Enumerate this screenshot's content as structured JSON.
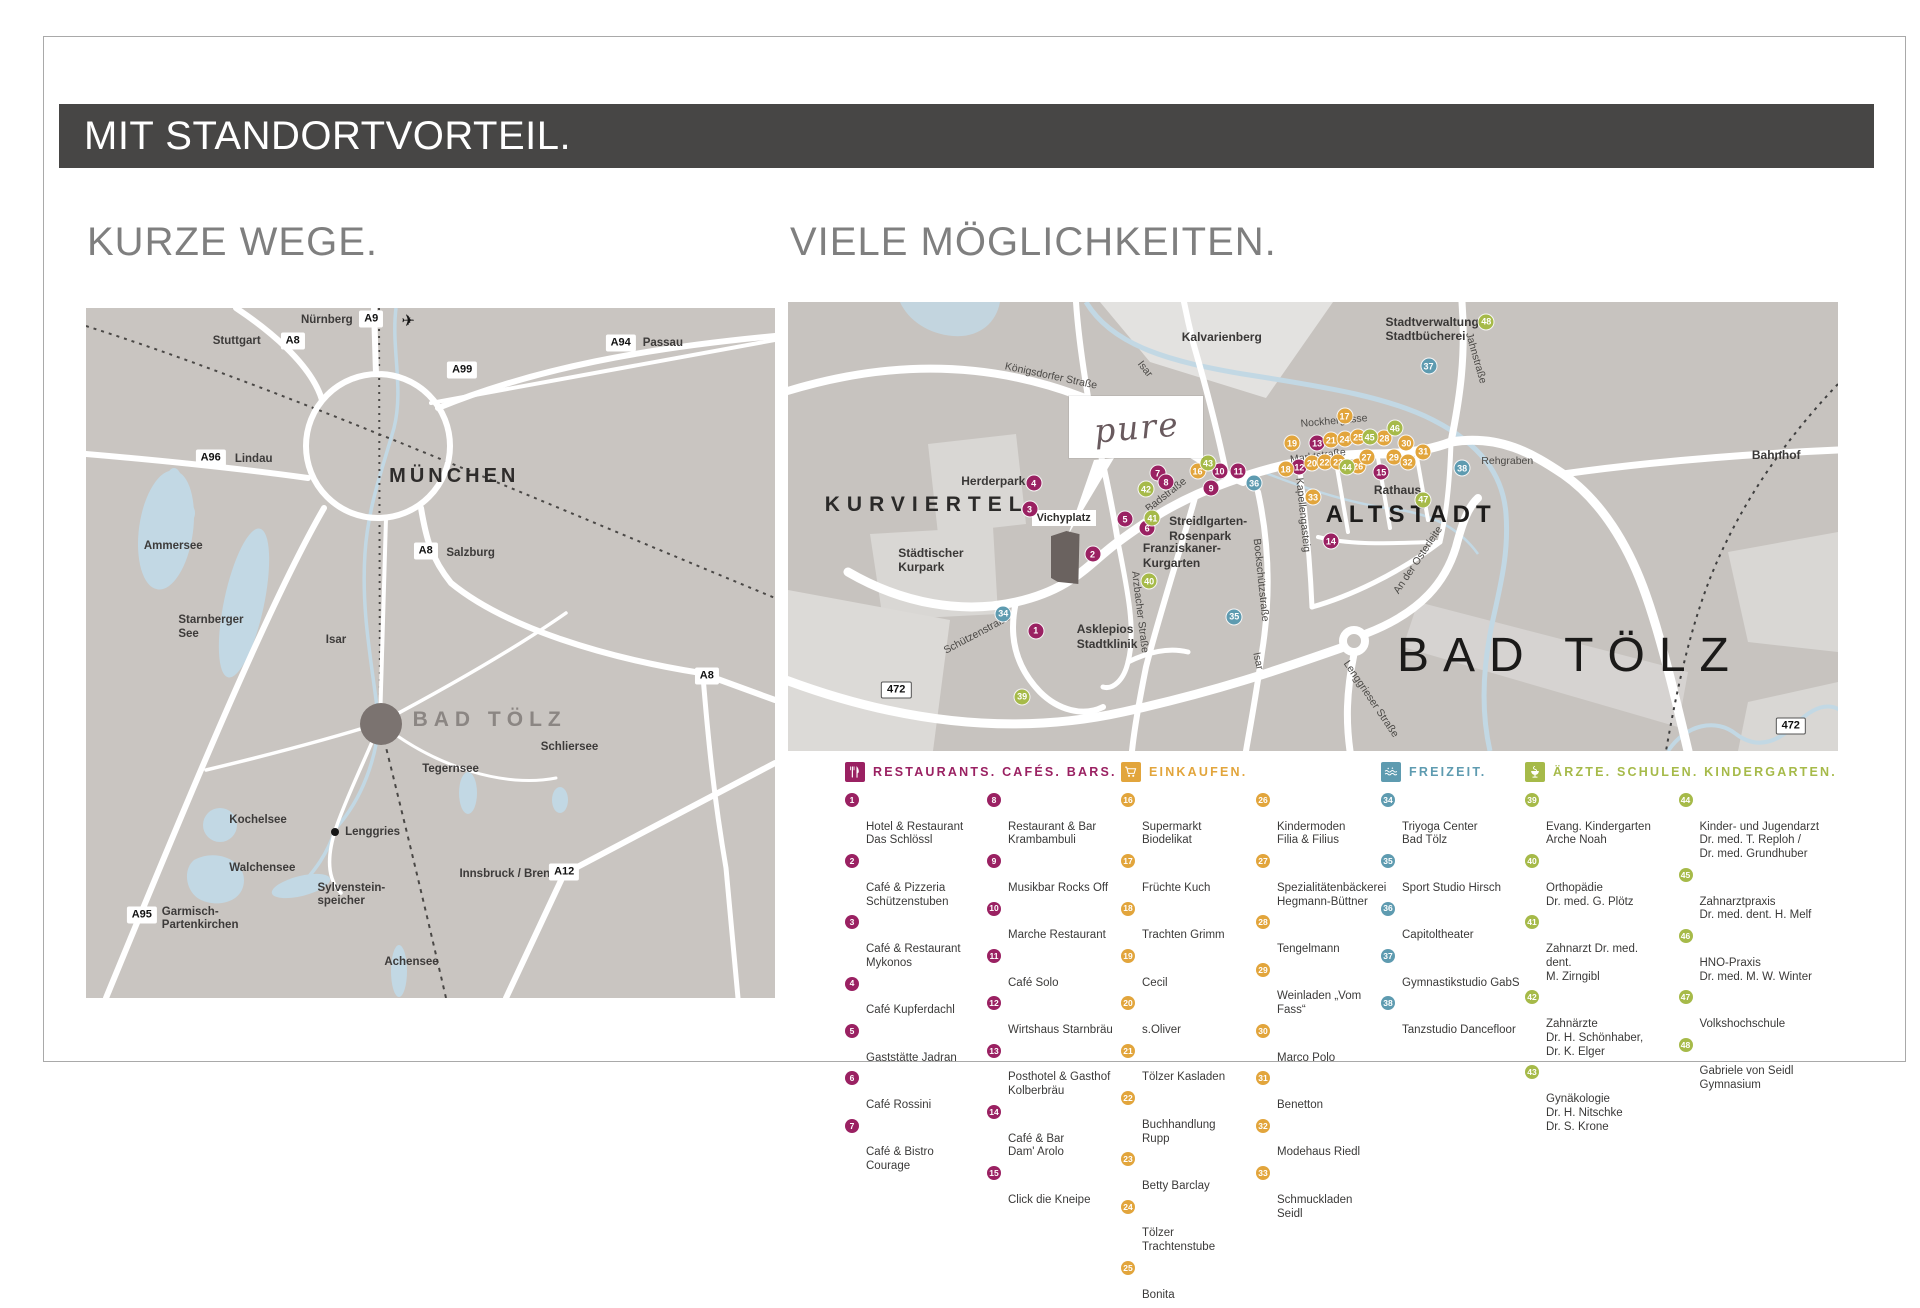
{
  "slide": {
    "title": "MIT STANDORTVORTEIL."
  },
  "headings": {
    "left": "KURZE WEGE.",
    "right": "VIELE MÖGLICHKEITEN."
  },
  "colors": {
    "bar_bg": "#474645",
    "heading": "#7f7f7f",
    "map_bg": "#c9c5c1",
    "map_bg2": "#c7c3bf",
    "water": "#c2d8e4",
    "rest": "#9a2162",
    "shop": "#e2a53c",
    "leisure": "#5e9bb0",
    "health": "#a6ba49",
    "bad_toelz_dot": "#7b7370",
    "bad_toelz_text": "#8b8683",
    "building": "#6a625f",
    "item_text": "#3b3a39",
    "map_label": "#3d3b3a"
  },
  "overview_map": {
    "munich": "MÜNCHEN",
    "bad_toelz": "BAD TÖLZ",
    "plane_icon": "✈",
    "motorway_badges": [
      {
        "t": "A9",
        "x": "41.4%",
        "y": "1.6%"
      },
      {
        "t": "A8",
        "x": "30.0%",
        "y": "4.8%"
      },
      {
        "t": "A94",
        "x": "77.6%",
        "y": "5.0%"
      },
      {
        "t": "A99",
        "x": "54.6%",
        "y": "9.0%"
      },
      {
        "t": "A96",
        "x": "18.1%",
        "y": "21.7%"
      },
      {
        "t": "A8",
        "x": "49.3%",
        "y": "35.2%"
      },
      {
        "t": "A8",
        "x": "90.1%",
        "y": "53.3%"
      },
      {
        "t": "A95",
        "x": "8.1%",
        "y": "88.0%"
      },
      {
        "t": "A12",
        "x": "69.4%",
        "y": "81.8%"
      }
    ],
    "place_labels": [
      {
        "t": "Nürnberg",
        "x": "31.2%",
        "y": "0.9%"
      },
      {
        "t": "Stuttgart",
        "x": "18.4%",
        "y": "3.9%"
      },
      {
        "t": "Passau",
        "x": "80.8%",
        "y": "4.2%"
      },
      {
        "t": "Lindau",
        "x": "21.6%",
        "y": "21.0%"
      },
      {
        "t": "Salzburg",
        "x": "52.3%",
        "y": "34.6%"
      },
      {
        "t": "Ammersee",
        "x": "8.4%",
        "y": "33.6%"
      },
      {
        "t": "Starnberger\nSee",
        "x": "13.4%",
        "y": "44.4%"
      },
      {
        "t": "Isar",
        "x": "34.8%",
        "y": "47.2%"
      },
      {
        "t": "Schliersee",
        "x": "66.0%",
        "y": "62.8%"
      },
      {
        "t": "Tegernsee",
        "x": "48.8%",
        "y": "65.9%"
      },
      {
        "t": "Kochelsee",
        "x": "20.8%",
        "y": "73.4%"
      },
      {
        "t": "Lenggries",
        "x": "37.6%",
        "y": "75.0%"
      },
      {
        "t": "Walchensee",
        "x": "20.8%",
        "y": "80.3%"
      },
      {
        "t": "Sylvenstein-\nspeicher",
        "x": "33.6%",
        "y": "83.2%"
      },
      {
        "t": "Garmisch-\nPartenkirchen",
        "x": "11.0%",
        "y": "86.6%"
      },
      {
        "t": "Innsbruck / Brenner",
        "x": "54.2%",
        "y": "81.2%"
      },
      {
        "t": "Achensee",
        "x": "43.3%",
        "y": "93.9%"
      }
    ]
  },
  "city_map": {
    "pure_logo": "pure",
    "big_label": "BAD TÖLZ",
    "kurviertel": "KURVIERTEL",
    "altstadt": "ALTSTADT",
    "vichyplatz": "Vichyplatz",
    "area_labels": [
      {
        "t": "Kalvarienberg",
        "x": "37.5%",
        "y": "6.3%"
      },
      {
        "t": "Stadtverwaltung\nStadtbücherei",
        "x": "56.9%",
        "y": "2.8%"
      },
      {
        "t": "Herderpark",
        "x": "16.5%",
        "y": "38.3%"
      },
      {
        "t": "Städtischer\nKurpark",
        "x": "10.5%",
        "y": "54.3%"
      },
      {
        "t": "Asklepios\nStadtklinik",
        "x": "27.5%",
        "y": "71.3%"
      },
      {
        "t": "Streidlgarten-\nRosenpark",
        "x": "36.3%",
        "y": "47.3%"
      },
      {
        "t": "Franziskaner-\nKurgarten",
        "x": "33.8%",
        "y": "53.3%"
      },
      {
        "t": "Rathaus",
        "x": "55.8%",
        "y": "40.3%"
      },
      {
        "t": "Bahnhof",
        "x": "91.8%",
        "y": "32.6%"
      }
    ],
    "street_labels": [
      {
        "t": "Königsdorfer Straße",
        "x": "25%",
        "y": "16.5%",
        "rot": "12deg"
      },
      {
        "t": "Isar",
        "x": "34%",
        "y": "15%",
        "rot": "52deg"
      },
      {
        "t": "Nockhergasse",
        "x": "52%",
        "y": "26.5%",
        "rot": "-5deg"
      },
      {
        "t": "Marktstraße",
        "x": "50.5%",
        "y": "34.3%",
        "rot": "-8deg"
      },
      {
        "t": "Jahnstraße",
        "x": "65.5%",
        "y": "12.5%",
        "rot": "74deg"
      },
      {
        "t": "Badstraße",
        "x": "36%",
        "y": "43%",
        "rot": "-38deg"
      },
      {
        "t": "Schützenstraße",
        "x": "18%",
        "y": "74%",
        "rot": "-28deg"
      },
      {
        "t": "Arzbacher Straße",
        "x": "33.5%",
        "y": "69%",
        "rot": "83deg"
      },
      {
        "t": "Bockschützstraße",
        "x": "45%",
        "y": "62%",
        "rot": "84deg"
      },
      {
        "t": "Kapellengasteig",
        "x": "49%",
        "y": "47.5%",
        "rot": "84deg"
      },
      {
        "t": "An der Osterleite",
        "x": "60%",
        "y": "57.5%",
        "rot": "-56deg"
      },
      {
        "t": "Isar",
        "x": "44.8%",
        "y": "80%",
        "rot": "78deg"
      },
      {
        "t": "Lenggrieser Straße",
        "x": "55.5%",
        "y": "88.5%",
        "rot": "56deg"
      },
      {
        "t": "Rehgraben",
        "x": "68.5%",
        "y": "35.5%",
        "rot": "0deg"
      }
    ],
    "route_badges": [
      {
        "t": "472",
        "x": "10.3%",
        "y": "86.5%"
      },
      {
        "t": "472",
        "x": "95.5%",
        "y": "94.5%"
      }
    ],
    "pois": {
      "restaurants": [
        {
          "n": "1",
          "x": "23.6%",
          "y": "73.2%"
        },
        {
          "n": "2",
          "x": "29.0%",
          "y": "56.2%"
        },
        {
          "n": "3",
          "x": "23.0%",
          "y": "46.2%"
        },
        {
          "n": "4",
          "x": "23.4%",
          "y": "40.4%"
        },
        {
          "n": "5",
          "x": "32.1%",
          "y": "48.4%"
        },
        {
          "n": "6",
          "x": "34.2%",
          "y": "50.4%"
        },
        {
          "n": "7",
          "x": "35.2%",
          "y": "38.1%"
        },
        {
          "n": "8",
          "x": "36.0%",
          "y": "40.1%"
        },
        {
          "n": "9",
          "x": "40.3%",
          "y": "41.5%"
        },
        {
          "n": "10",
          "x": "41.1%",
          "y": "37.7%"
        },
        {
          "n": "11",
          "x": "42.9%",
          "y": "37.7%"
        },
        {
          "n": "12",
          "x": "48.7%",
          "y": "36.8%"
        },
        {
          "n": "13",
          "x": "50.4%",
          "y": "31.5%"
        },
        {
          "n": "14",
          "x": "51.7%",
          "y": "53.3%"
        },
        {
          "n": "15",
          "x": "56.5%",
          "y": "37.9%"
        }
      ],
      "shopping": [
        {
          "n": "16",
          "x": "39.0%",
          "y": "37.7%"
        },
        {
          "n": "17",
          "x": "53.0%",
          "y": "25.5%"
        },
        {
          "n": "18",
          "x": "47.4%",
          "y": "37.3%"
        },
        {
          "n": "19",
          "x": "48.0%",
          "y": "31.5%"
        },
        {
          "n": "20",
          "x": "49.9%",
          "y": "35.9%"
        },
        {
          "n": "21",
          "x": "51.7%",
          "y": "30.8%"
        },
        {
          "n": "22",
          "x": "51.1%",
          "y": "35.7%"
        },
        {
          "n": "23",
          "x": "52.4%",
          "y": "35.7%"
        },
        {
          "n": "24",
          "x": "53.0%",
          "y": "30.6%"
        },
        {
          "n": "25",
          "x": "54.3%",
          "y": "30.1%"
        },
        {
          "n": "26",
          "x": "54.3%",
          "y": "36.6%"
        },
        {
          "n": "27",
          "x": "55.1%",
          "y": "34.6%"
        },
        {
          "n": "28",
          "x": "56.8%",
          "y": "30.4%"
        },
        {
          "n": "29",
          "x": "57.7%",
          "y": "34.6%"
        },
        {
          "n": "30",
          "x": "58.9%",
          "y": "31.5%"
        },
        {
          "n": "31",
          "x": "60.5%",
          "y": "33.3%"
        },
        {
          "n": "32",
          "x": "59.0%",
          "y": "35.7%"
        },
        {
          "n": "33",
          "x": "50.0%",
          "y": "43.5%"
        }
      ],
      "leisure": [
        {
          "n": "34",
          "x": "20.5%",
          "y": "69.4%"
        },
        {
          "n": "35",
          "x": "42.5%",
          "y": "70.1%"
        },
        {
          "n": "36",
          "x": "44.4%",
          "y": "40.4%"
        },
        {
          "n": "37",
          "x": "61.0%",
          "y": "14.3%"
        },
        {
          "n": "38",
          "x": "64.2%",
          "y": "37.0%"
        }
      ],
      "health": [
        {
          "n": "39",
          "x": "22.3%",
          "y": "87.9%"
        },
        {
          "n": "40",
          "x": "34.4%",
          "y": "62.2%"
        },
        {
          "n": "41",
          "x": "34.7%",
          "y": "48.2%"
        },
        {
          "n": "42",
          "x": "34.1%",
          "y": "41.7%"
        },
        {
          "n": "43",
          "x": "40.0%",
          "y": "35.9%"
        },
        {
          "n": "44",
          "x": "53.2%",
          "y": "36.8%"
        },
        {
          "n": "45",
          "x": "55.4%",
          "y": "30.1%"
        },
        {
          "n": "46",
          "x": "57.8%",
          "y": "28.1%"
        },
        {
          "n": "47",
          "x": "60.5%",
          "y": "44.0%"
        },
        {
          "n": "48",
          "x": "66.5%",
          "y": "4.4%"
        }
      ]
    }
  },
  "legend": {
    "categories": [
      {
        "title": "RESTAURANTS. CAFÉS. BARS.",
        "icon": "fork-knife-icon",
        "col_a": [
          {
            "n": "1",
            "t": "Hotel & Restaurant\nDas Schlössl"
          },
          {
            "n": "2",
            "t": "Café & Pizzeria\nSchützenstuben"
          },
          {
            "n": "3",
            "t": "Café & Restaurant\nMykonos"
          },
          {
            "n": "4",
            "t": "Café Kupferdachl"
          },
          {
            "n": "5",
            "t": "Gaststätte Jadran"
          },
          {
            "n": "6",
            "t": "Café Rossini"
          },
          {
            "n": "7",
            "t": "Café & Bistro\nCourage"
          }
        ],
        "col_b": [
          {
            "n": "8",
            "t": "Restaurant & Bar\nKrambambuli"
          },
          {
            "n": "9",
            "t": "Musikbar Rocks Off"
          },
          {
            "n": "10",
            "t": "Marche Restaurant"
          },
          {
            "n": "11",
            "t": "Café Solo"
          },
          {
            "n": "12",
            "t": "Wirtshaus Starnbräu"
          },
          {
            "n": "13",
            "t": "Posthotel & Gasthof\nKolberbräu"
          },
          {
            "n": "14",
            "t": "Café & Bar\nDam' Arolo"
          },
          {
            "n": "15",
            "t": "Click die Kneipe"
          }
        ]
      },
      {
        "title": "EINKAUFEN.",
        "icon": "shopping-cart-icon",
        "col_a": [
          {
            "n": "16",
            "t": "Supermarkt Biodelikat"
          },
          {
            "n": "17",
            "t": "Früchte Kuch"
          },
          {
            "n": "18",
            "t": "Trachten Grimm"
          },
          {
            "n": "19",
            "t": "Cecil"
          },
          {
            "n": "20",
            "t": "s.Oliver"
          },
          {
            "n": "21",
            "t": "Tölzer Kasladen"
          },
          {
            "n": "22",
            "t": "Buchhandlung Rupp"
          },
          {
            "n": "23",
            "t": "Betty Barclay"
          },
          {
            "n": "24",
            "t": "Tölzer Trachtenstube"
          },
          {
            "n": "25",
            "t": "Bonita"
          }
        ],
        "col_b": [
          {
            "n": "26",
            "t": "Kindermoden\nFilia & Filius"
          },
          {
            "n": "27",
            "t": "Spezialitätenbäckerei\nHegmann-Büttner"
          },
          {
            "n": "28",
            "t": "Tengelmann"
          },
          {
            "n": "29",
            "t": "Weinladen „Vom Fass“"
          },
          {
            "n": "30",
            "t": "Marco Polo"
          },
          {
            "n": "31",
            "t": "Benetton"
          },
          {
            "n": "32",
            "t": "Modehaus Riedl"
          },
          {
            "n": "33",
            "t": "Schmuckladen Seidl"
          }
        ]
      },
      {
        "title": "FREIZEIT.",
        "icon": "waves-icon",
        "col_a": [
          {
            "n": "34",
            "t": "Triyoga Center\nBad Tölz"
          },
          {
            "n": "35",
            "t": "Sport Studio Hirsch"
          },
          {
            "n": "36",
            "t": "Capitoltheater"
          },
          {
            "n": "37",
            "t": "Gymnastikstudio GabS"
          },
          {
            "n": "38",
            "t": "Tanzstudio Dancefloor"
          }
        ],
        "col_b": []
      },
      {
        "title": "ÄRZTE. SCHULEN. KINDERGARTEN.",
        "icon": "hygieia-bowl-icon",
        "col_a": [
          {
            "n": "39",
            "t": "Evang. Kindergarten\nArche Noah"
          },
          {
            "n": "40",
            "t": "Orthopädie\nDr. med. G. Plötz"
          },
          {
            "n": "41",
            "t": "Zahnarzt Dr. med. dent.\nM. Zirngibl"
          },
          {
            "n": "42",
            "t": "Zahnärzte\nDr. H. Schönhaber,\nDr. K. Elger"
          },
          {
            "n": "43",
            "t": "Gynäkologie\nDr. H. Nitschke\nDr. S. Krone"
          }
        ],
        "col_b": [
          {
            "n": "44",
            "t": "Kinder- und Jugendarzt\nDr. med. T. Reploh /\nDr. med. Grundhuber"
          },
          {
            "n": "45",
            "t": "Zahnarztpraxis\nDr. med. dent. H. Melf"
          },
          {
            "n": "46",
            "t": "HNO-Praxis\nDr. med. M. W. Winter"
          },
          {
            "n": "47",
            "t": "Volkshochschule"
          },
          {
            "n": "48",
            "t": "Gabriele von Seidl\nGymnasium"
          }
        ]
      }
    ]
  }
}
